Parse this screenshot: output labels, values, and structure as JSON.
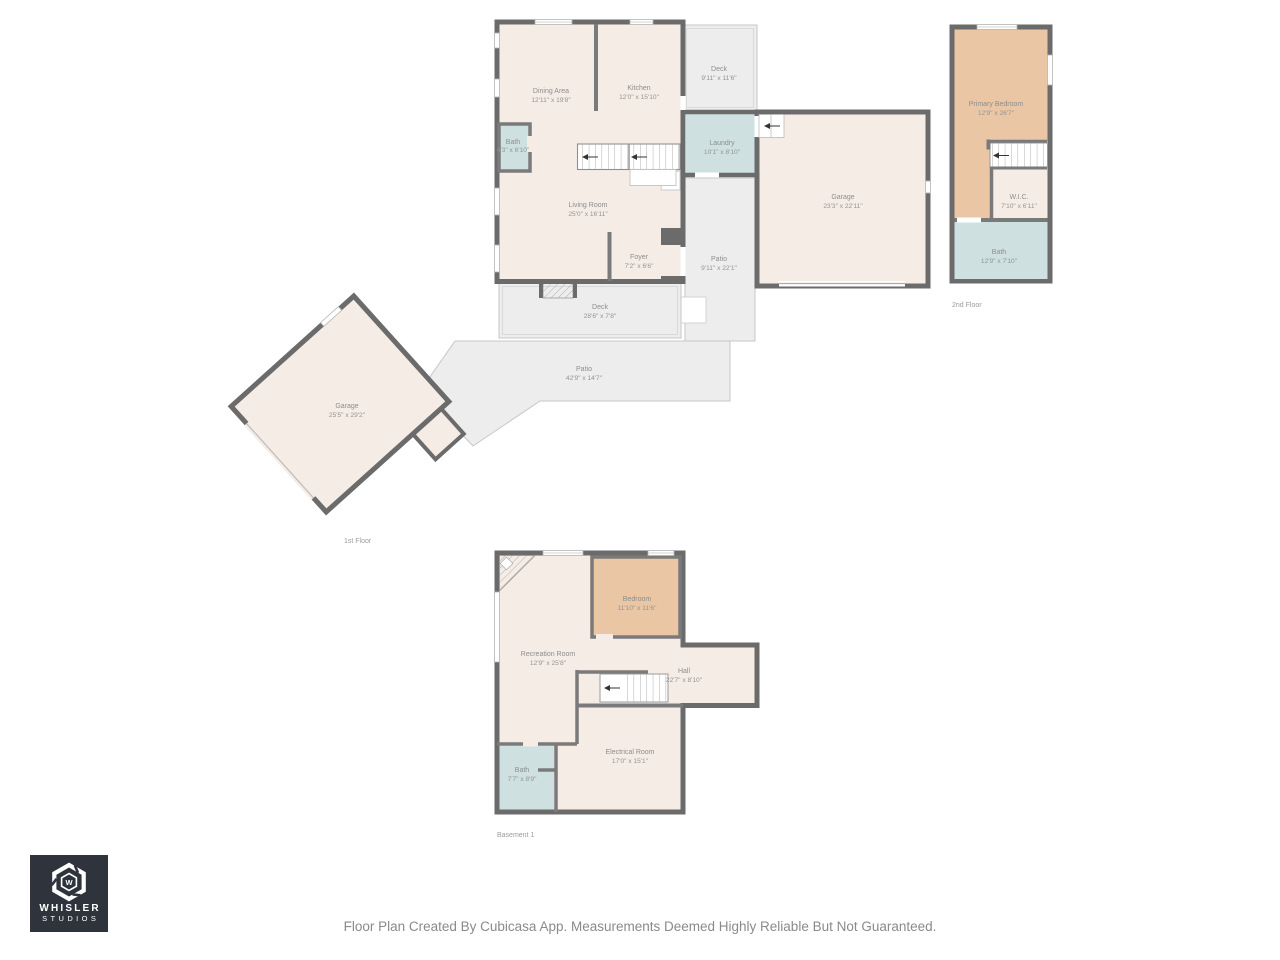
{
  "caption": "Floor Plan Created By Cubicasa App. Measurements Deemed Highly Reliable But Not Guaranteed.",
  "logo": {
    "monogram": "W",
    "line1": "WHISLER",
    "line2": "STUDIOS"
  },
  "colors": {
    "wall_exterior": "#6b6b6b",
    "wall_interior": "#7a7a7a",
    "room_fill": "#f6ece6",
    "bedroom_fill": "#eac6a4",
    "bath_fill": "#cfe0e0",
    "outdoor_fill": "#ededed",
    "outdoor_line": "#c7c7c7",
    "label_text": "#8d8d8d",
    "logo_background": "#2e333c"
  },
  "floors": {
    "first": {
      "label": "1st Floor",
      "rooms": {
        "dining_area": {
          "name": "Dining Area",
          "dims": "12'11\" x 19'8\""
        },
        "kitchen": {
          "name": "Kitchen",
          "dims": "12'0\" x 15'10\""
        },
        "deck_upper": {
          "name": "Deck",
          "dims": "9'11\" x 11'6\""
        },
        "bath": {
          "name": "Bath",
          "dims": "4'3\" x 6'10\""
        },
        "laundry": {
          "name": "Laundry",
          "dims": "10'1\" x 8'10\""
        },
        "living_room": {
          "name": "Living Room",
          "dims": "25'0\" x 16'11\""
        },
        "foyer": {
          "name": "Foyer",
          "dims": "7'2\" x 6'6\""
        },
        "patio_side": {
          "name": "Patio",
          "dims": "9'11\" x 22'1\""
        },
        "garage_attached": {
          "name": "Garage",
          "dims": "23'3\" x 22'11\""
        },
        "deck_lower": {
          "name": "Deck",
          "dims": "28'6\" x 7'8\""
        },
        "patio_rear": {
          "name": "Patio",
          "dims": "42'9\" x 14'7\""
        },
        "garage_detached": {
          "name": "Garage",
          "dims": "25'5\" x 29'2\""
        }
      }
    },
    "second": {
      "label": "2nd Floor",
      "rooms": {
        "primary_bedroom": {
          "name": "Primary Bedroom",
          "dims": "12'9\" x 26'7\""
        },
        "wic": {
          "name": "W.I.C.",
          "dims": "7'10\" x 6'11\""
        },
        "bath": {
          "name": "Bath",
          "dims": "12'9\" x 7'10\""
        }
      }
    },
    "basement": {
      "label": "Basement 1",
      "rooms": {
        "recreation_room": {
          "name": "Recreation Room",
          "dims": "12'9\" x 25'8\""
        },
        "bedroom": {
          "name": "Bedroom",
          "dims": "11'10\" x 11'6\""
        },
        "hall": {
          "name": "Hall",
          "dims": "22'7\" x 8'10\""
        },
        "electrical_room": {
          "name": "Electrical Room",
          "dims": "17'0\" x 15'1\""
        },
        "bath": {
          "name": "Bath",
          "dims": "7'7\" x 8'9\""
        }
      }
    }
  }
}
